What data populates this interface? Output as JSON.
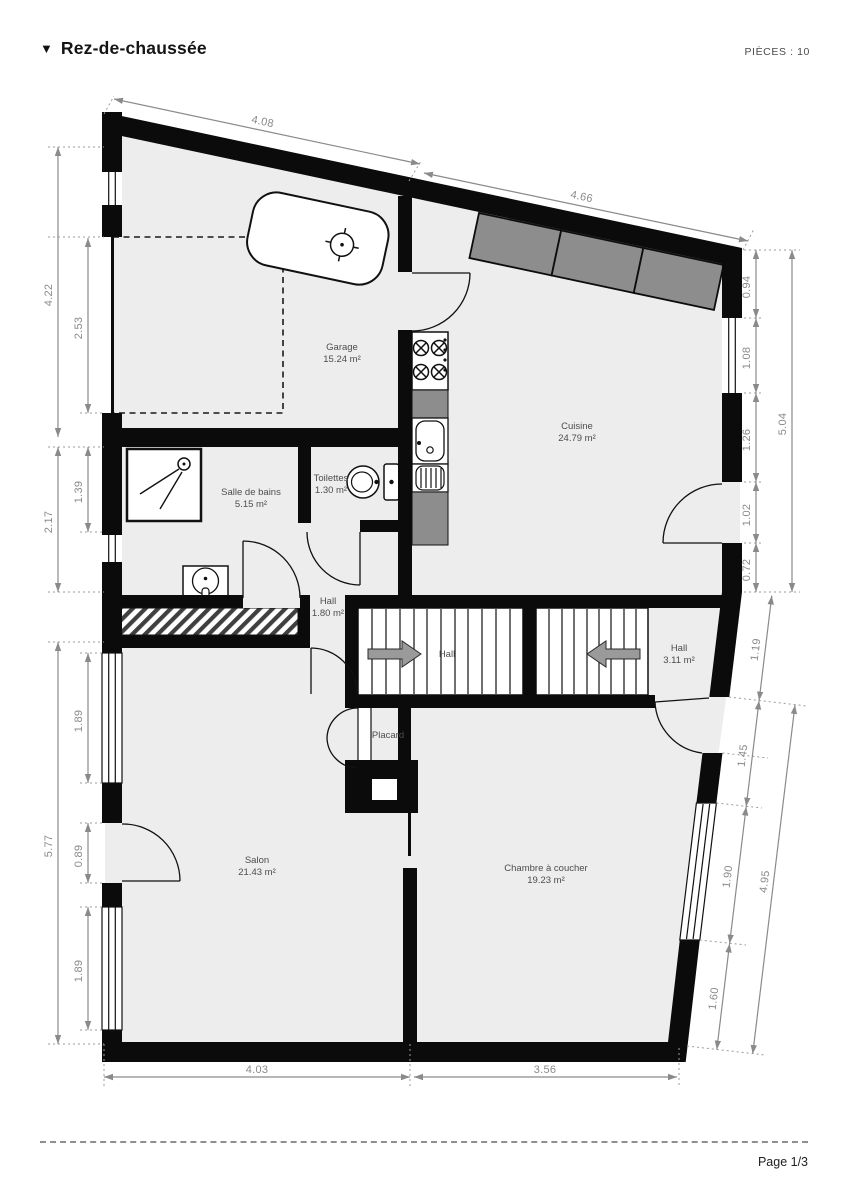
{
  "header": {
    "collapse_icon": "triangle-down-icon",
    "title": "Rez-de-chaussée",
    "pieces_label": "PIÈCES : 10"
  },
  "footer": {
    "page_label": "Page 1/3"
  },
  "plan": {
    "rooms": [
      {
        "name": "Garage",
        "area": "15.24 m²"
      },
      {
        "name": "Cuisine",
        "area": "24.79 m²"
      },
      {
        "name": "Salle de bains",
        "area": "5.15 m²"
      },
      {
        "name": "Toilettes",
        "area": "1.30 m²"
      },
      {
        "name": "Hall",
        "area": "1.80 m²"
      },
      {
        "name": "Hall"
      },
      {
        "name": "Hall",
        "area": "3.11 m²"
      },
      {
        "name": "Placard"
      },
      {
        "name": "Salon",
        "area": "21.43 m²"
      },
      {
        "name": "Chambre à coucher",
        "area": "19.23 m²"
      }
    ],
    "dimensions": {
      "top": [
        "4.08",
        "4.66"
      ],
      "left": [
        "4.22",
        "2.53",
        "2.17",
        "1.39",
        "5.77",
        "1.89",
        "0.89",
        "1.89"
      ],
      "right": [
        "0.94",
        "1.08",
        "1.26",
        "1.02",
        "0.72",
        "5.04"
      ],
      "right_lower": [
        "1.19",
        "1.45",
        "1.90",
        "1.60",
        "4.95"
      ],
      "bottom": [
        "4.03",
        "3.56"
      ]
    },
    "fixtures": [
      "bathtub",
      "faucet",
      "gas-hob",
      "countertop",
      "kitchen-sink",
      "draining-board",
      "toilet",
      "shower",
      "washbasin",
      "staircase-up-arrow",
      "staircase-down-arrow",
      "wardrobe-bifold-doors",
      "hatched-ramp",
      "reserved-area-dashed-outline"
    ],
    "colors": {
      "wall": "#0b0b0b",
      "floor": "#ededed",
      "counter": "#8d8d8d",
      "dimension": "#8a8a8a",
      "room_label": "#4d4d4d",
      "stair_arrow": "#9a9a9a"
    }
  }
}
